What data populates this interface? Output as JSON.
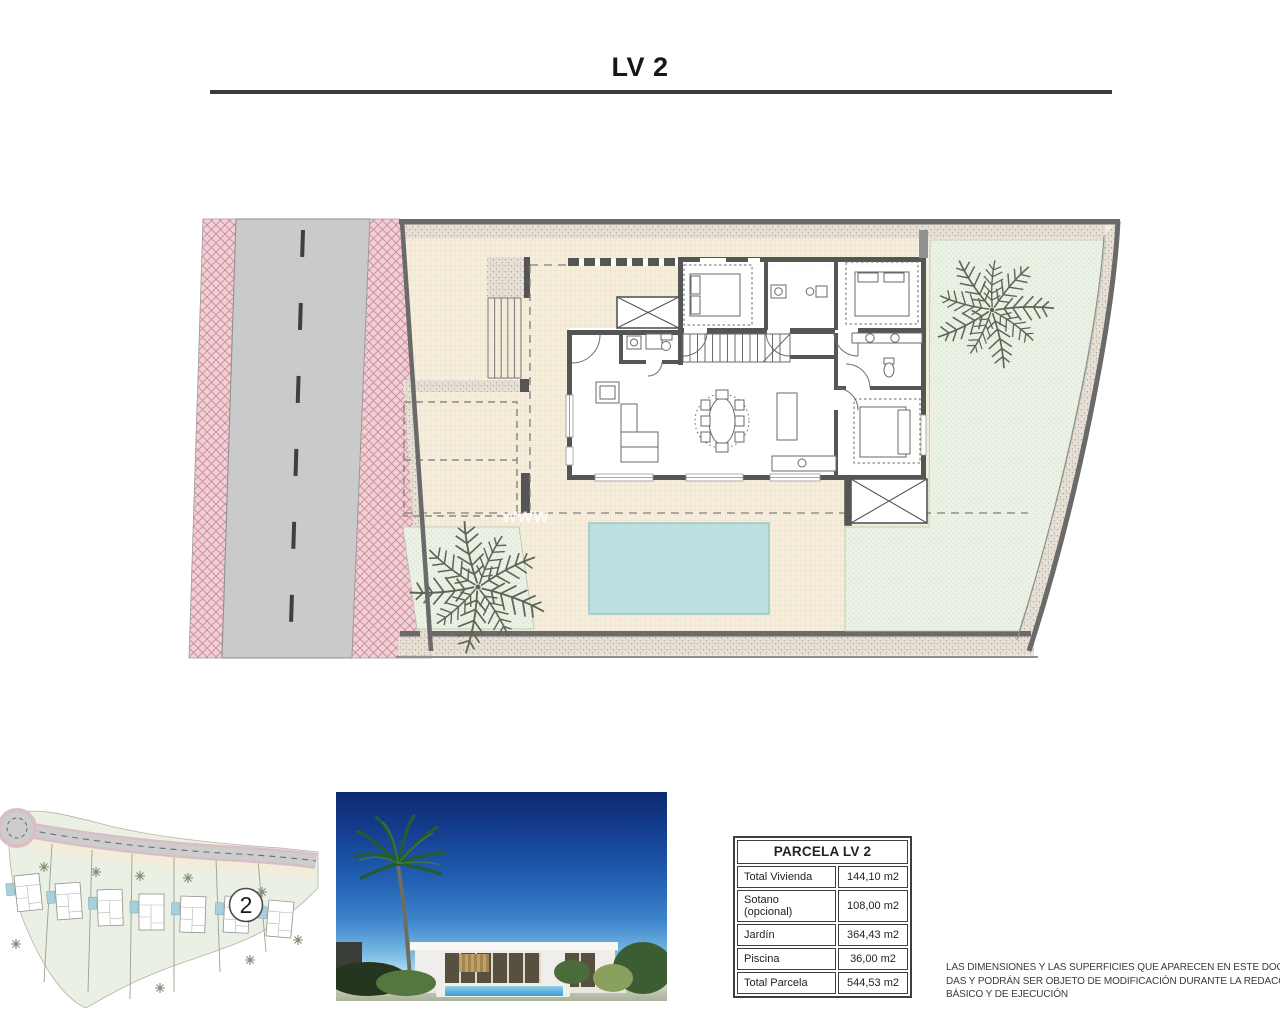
{
  "title": "LV 2",
  "plan": {
    "watermark": "www"
  },
  "minimap": {
    "badge_number": "2"
  },
  "parcel_table": {
    "header": "PARCELA LV 2",
    "rows": [
      {
        "label": "Total Vivienda",
        "value": "144,10 m2"
      },
      {
        "label": "Sotano (opcional)",
        "value": "108,00 m2"
      },
      {
        "label": "Jardín",
        "value": "364,43 m2"
      },
      {
        "label": "Piscina",
        "value": "36,00 m2"
      },
      {
        "label": "Total Parcela",
        "value": "544,53 m2"
      }
    ]
  },
  "disclaimer": {
    "line1": "LAS DIMENSIONES Y LAS SUPERFICIES QUE APARECEN EN ESTE DOCUMENTO SON",
    "line2": "DAS Y PODRÁN SER OBJETO DE MODIFICACIÓN DURANTE LA REDACCIÓN DE LOS",
    "line3": "BÁSICO Y DE EJECUCIÓN"
  },
  "colors": {
    "terrace_beige": "#f6eedc",
    "garden_green": "#ecf1e5",
    "pool_blue": "#bcdfdf",
    "road_gray": "#cacaca",
    "sidewalk_pink": "#f3ced4",
    "boundary_gray": "#6a6a6a",
    "wall_gray": "#555555",
    "sky_blue": "#2160b4"
  }
}
